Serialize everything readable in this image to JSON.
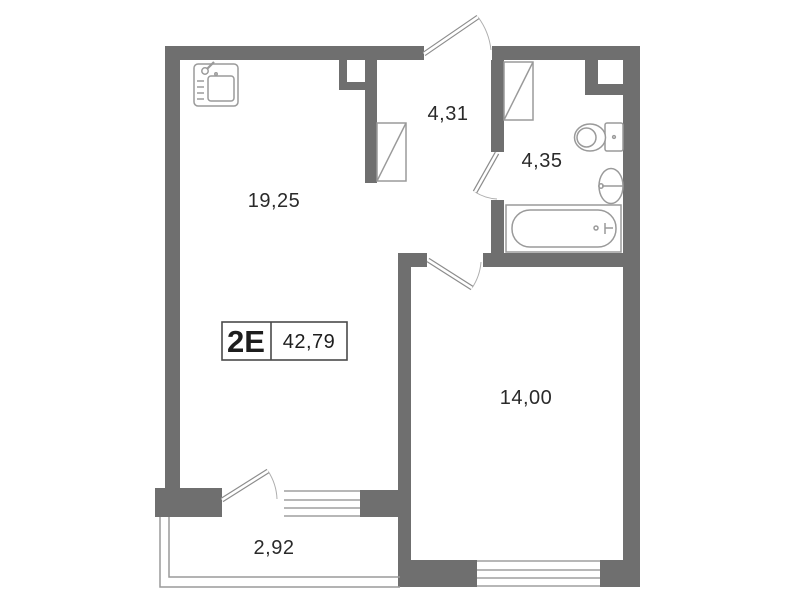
{
  "plan": {
    "unit_label": "2E",
    "total_area": "42,79",
    "rooms": [
      {
        "name": "living-room",
        "area": "19,25"
      },
      {
        "name": "hallway",
        "area": "4,31"
      },
      {
        "name": "bathroom",
        "area": "4,35"
      },
      {
        "name": "bedroom",
        "area": "14,00"
      },
      {
        "name": "balcony",
        "area": "2,92"
      }
    ],
    "fixtures": [
      "kitchen-sink-icon",
      "wardrobe-icon-hallway",
      "wardrobe-icon-bathroom",
      "toilet-icon",
      "washbasin-icon",
      "bathtub-icon"
    ],
    "doors": [
      "entrance-door",
      "bathroom-door",
      "bedroom-door",
      "balcony-door"
    ],
    "windows": [
      "balcony-window",
      "bedroom-window"
    ],
    "colors": {
      "wall": "#6f6f6f",
      "fixture_line": "#9a9a9a",
      "text": "#2a2a2a",
      "background": "#ffffff"
    }
  }
}
